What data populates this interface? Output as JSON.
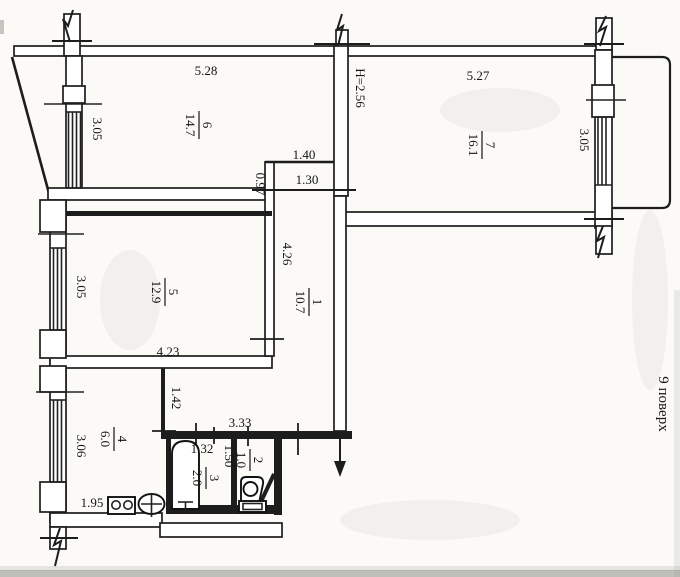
{
  "floor_note": "9 поверх",
  "rooms": [
    {
      "number": "6",
      "area": "14.7"
    },
    {
      "number": "7",
      "area": "16.1"
    },
    {
      "number": "1",
      "area": "10.7"
    },
    {
      "number": "5",
      "area": "12.9"
    },
    {
      "number": "4",
      "area": "6.0"
    },
    {
      "number": "3",
      "area": "2.0"
    },
    {
      "number": "2",
      "area": "1.0"
    }
  ],
  "dims": {
    "room6_width": "5.28",
    "room7_width": "5.27",
    "ceiling_height": "H=2.56",
    "room6_depth": "3.05",
    "room7_depth": "3.05",
    "room5_depth": "3.05",
    "closet_width": "1.40",
    "closet_inner_width": "1.30",
    "closet_depth": "0.97",
    "corridor_length": "4.26",
    "room5_width": "4.23",
    "kitchen_partition": "1.42",
    "kitchen_depth": "3.06",
    "bath_block_width": "3.33",
    "bathtub_length": "1.32",
    "bathroom_width": "1.50",
    "kitchen_width": "1.95"
  }
}
